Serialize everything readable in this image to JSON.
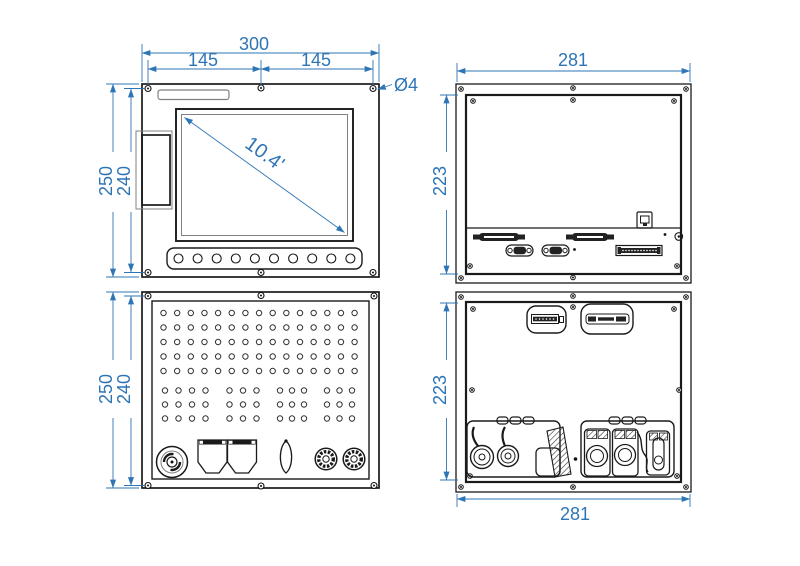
{
  "meta": {
    "type": "technical-drawing",
    "subject": "Industrial panel PC enclosure - four orthographic views with dimensions (mm)"
  },
  "colors": {
    "dimension": "#2E75B6",
    "line": "#1a1a1a",
    "secondary_line": "#808080",
    "background": "#ffffff"
  },
  "views": {
    "front_top": {
      "name": "front-view-display-unit",
      "dims": {
        "total_width": "300",
        "hole_span_left": "145",
        "hole_span_right": "145",
        "outer_height": "250",
        "hole_span_height": "240",
        "hole_diameter": "Ø4",
        "screen_diagonal": "10.4'"
      },
      "buttons": {
        "count": 10
      },
      "mount_hole_count": 6
    },
    "rear_top": {
      "name": "rear-view-display-unit",
      "dims": {
        "width": "281",
        "height": "223"
      }
    },
    "front_bottom": {
      "name": "front-view-vented-unit",
      "dims": {
        "outer_height": "250",
        "hole_span_height": "240"
      },
      "vent_grid": {
        "full_rows": 5,
        "full_cols": 15,
        "grouped_rows": 3,
        "groups": [
          4,
          3,
          3,
          3
        ]
      }
    },
    "rear_bottom": {
      "name": "rear-view-vented-unit",
      "dims": {
        "height": "223",
        "width": "281"
      }
    }
  }
}
